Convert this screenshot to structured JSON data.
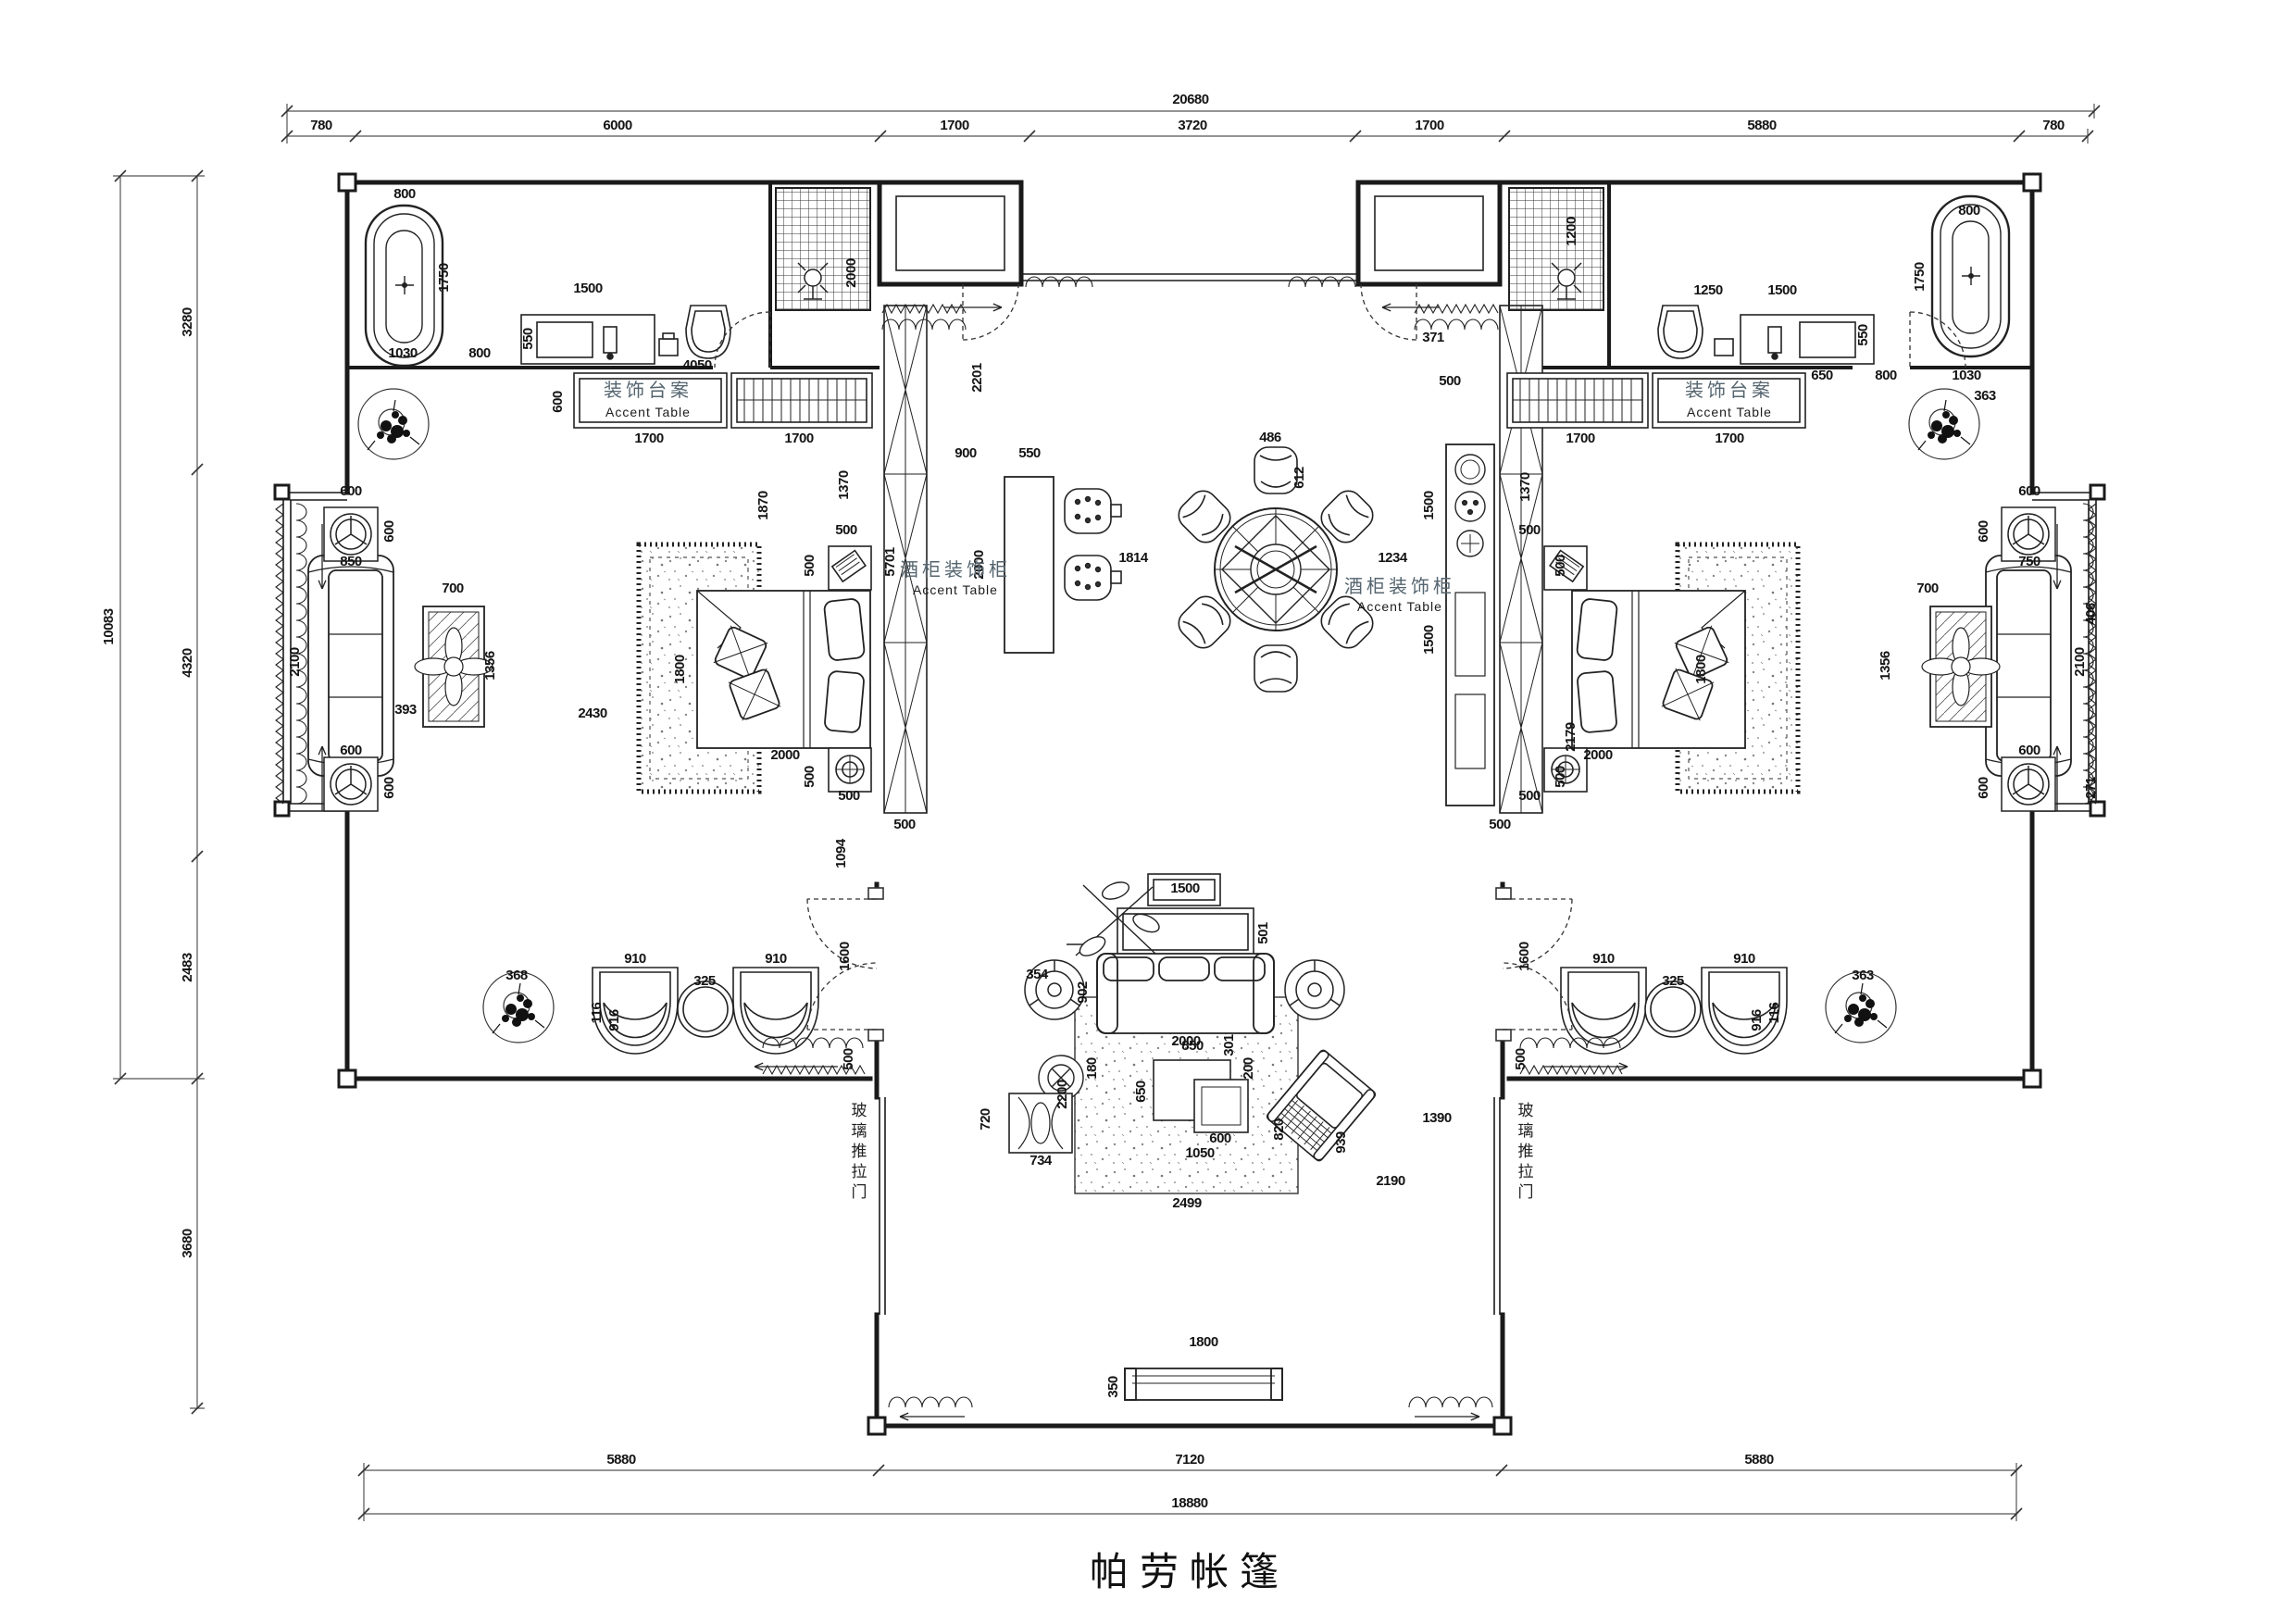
{
  "title": "帕劳帐篷",
  "drawing": {
    "type": "floor-plan",
    "line_color": "#1a1a1a",
    "dim_color": "#141414",
    "room_label_color": "#55656f"
  },
  "room_labels": {
    "accent_table_cn": "装饰台案",
    "accent_table_en": "Accent Table",
    "wine_cabinet_cn": "酒柜装饰柜",
    "wine_cabinet_en": "Accent Table",
    "glass_sliding_door": "玻璃推拉门"
  },
  "annotations": [
    {
      "region": "top-chain",
      "items": [
        [
          "20680",
          1286,
          112
        ],
        [
          "780",
          347,
          140
        ],
        [
          "6000",
          667,
          140
        ],
        [
          "1700",
          1031,
          140
        ],
        [
          "3720",
          1288,
          140
        ],
        [
          "1700",
          1544,
          140
        ],
        [
          "5880",
          1903,
          140
        ],
        [
          "780",
          2218,
          140
        ]
      ]
    },
    {
      "region": "left-chain",
      "items": [
        [
          "10083",
          122,
          677,
          1
        ],
        [
          "3280",
          207,
          348,
          1
        ],
        [
          "4320",
          207,
          716,
          1
        ],
        [
          "2483",
          207,
          1045,
          1
        ],
        [
          "3680",
          207,
          1343,
          1
        ]
      ]
    },
    {
      "region": "bottom-chain",
      "items": [
        [
          "5880",
          671,
          1581
        ],
        [
          "7120",
          1285,
          1581
        ],
        [
          "5880",
          1900,
          1581
        ],
        [
          "18880",
          1285,
          1628
        ]
      ]
    },
    {
      "region": "left-bathroom",
      "items": [
        [
          "800",
          437,
          214
        ],
        [
          "1750",
          484,
          300,
          1
        ],
        [
          "1030",
          435,
          386
        ],
        [
          "800",
          518,
          386
        ],
        [
          "1500",
          635,
          316
        ],
        [
          "550",
          575,
          366,
          1
        ],
        [
          "4050",
          753,
          399
        ],
        [
          "600",
          607,
          434,
          1
        ],
        [
          "1700",
          701,
          478
        ],
        [
          "1700",
          863,
          478
        ],
        [
          "2000",
          924,
          295,
          1
        ],
        [
          "装饰台案",
          700,
          428,
          0,
          "room-cn"
        ],
        [
          "Accent Table",
          700,
          450,
          0,
          "room-en"
        ]
      ]
    },
    {
      "region": "left-cabinet-bar",
      "items": [
        [
          "2201",
          1060,
          408,
          1
        ],
        [
          "900",
          1043,
          494
        ],
        [
          "550",
          1112,
          494
        ],
        [
          "2000",
          1062,
          610,
          1
        ],
        [
          "5701",
          966,
          607,
          1
        ],
        [
          "500",
          977,
          895
        ],
        [
          "酒柜装饰柜",
          1032,
          622,
          0,
          "room-cn"
        ],
        [
          "Accent Table",
          1032,
          642,
          0,
          "room-en"
        ]
      ]
    },
    {
      "region": "left-bedroom",
      "items": [
        [
          "1870",
          829,
          546,
          1
        ],
        [
          "1370",
          916,
          524,
          1
        ],
        [
          "500",
          914,
          577
        ],
        [
          "500",
          879,
          611,
          1
        ],
        [
          "1800",
          739,
          723,
          1
        ],
        [
          "2000",
          848,
          820
        ],
        [
          "500",
          879,
          839,
          1
        ],
        [
          "500",
          917,
          864
        ],
        [
          "1094",
          913,
          922,
          1
        ],
        [
          "2430",
          640,
          775
        ],
        [
          "393",
          438,
          771
        ],
        [
          "700",
          489,
          640
        ],
        [
          "1356",
          534,
          719,
          1
        ],
        [
          "2100",
          323,
          715,
          1
        ],
        [
          "850",
          379,
          611
        ],
        [
          "600",
          379,
          535
        ],
        [
          "600",
          425,
          574,
          1
        ],
        [
          "600",
          379,
          815
        ],
        [
          "600",
          425,
          851,
          1
        ]
      ]
    },
    {
      "region": "left-wing",
      "items": [
        [
          "368",
          558,
          1058
        ],
        [
          "910",
          686,
          1040
        ],
        [
          "325",
          761,
          1064
        ],
        [
          "910",
          838,
          1040
        ],
        [
          "916",
          668,
          1102,
          1
        ],
        [
          "116",
          649,
          1094,
          1
        ],
        [
          "1600",
          917,
          1033,
          1
        ],
        [
          "500",
          921,
          1144,
          1
        ]
      ]
    },
    {
      "region": "dining",
      "items": [
        [
          "486",
          1372,
          477
        ],
        [
          "612",
          1408,
          516,
          1
        ],
        [
          "1814",
          1224,
          607
        ],
        [
          "1234",
          1504,
          607
        ]
      ]
    },
    {
      "region": "kitchen",
      "items": [
        [
          "371",
          1548,
          369
        ],
        [
          "500",
          1566,
          416
        ],
        [
          "1500",
          1548,
          546,
          1
        ],
        [
          "1500",
          1548,
          691,
          1
        ],
        [
          "1370",
          1652,
          526,
          1
        ],
        [
          "2179",
          1701,
          796,
          1
        ],
        [
          "500",
          1620,
          895
        ]
      ]
    },
    {
      "region": "right-cabinet",
      "items": [
        [
          "酒柜装饰柜",
          1512,
          640,
          0,
          "room-cn"
        ],
        [
          "Accent Table",
          1512,
          660,
          0,
          "room-en"
        ]
      ]
    },
    {
      "region": "right-bedroom",
      "items": [
        [
          "500",
          1652,
          577
        ],
        [
          "500",
          1690,
          611,
          1
        ],
        [
          "500",
          1690,
          839,
          1
        ],
        [
          "500",
          1652,
          864
        ],
        [
          "2000",
          1726,
          820
        ],
        [
          "1800",
          1842,
          723,
          1
        ],
        [
          "700",
          2082,
          640
        ],
        [
          "1356",
          2041,
          719,
          1
        ],
        [
          "2100",
          2251,
          715,
          1
        ],
        [
          "406",
          2263,
          663,
          1
        ],
        [
          "750",
          2192,
          611
        ],
        [
          "600",
          2192,
          535
        ],
        [
          "600",
          2147,
          574,
          1
        ],
        [
          "600",
          2192,
          815
        ],
        [
          "600",
          2147,
          851,
          1
        ],
        [
          "271",
          2263,
          851,
          1
        ]
      ]
    },
    {
      "region": "right-wing",
      "items": [
        [
          "910",
          1732,
          1040
        ],
        [
          "325",
          1807,
          1064
        ],
        [
          "910",
          1884,
          1040
        ],
        [
          "363",
          2012,
          1058
        ],
        [
          "116",
          1921,
          1094,
          1
        ],
        [
          "916",
          1902,
          1102,
          1
        ],
        [
          "1600",
          1651,
          1033,
          1
        ],
        [
          "500",
          1647,
          1144,
          1
        ]
      ]
    },
    {
      "region": "right-bathroom",
      "items": [
        [
          "1250",
          1845,
          318
        ],
        [
          "1500",
          1925,
          318
        ],
        [
          "550",
          2017,
          362,
          1
        ],
        [
          "800",
          2127,
          232
        ],
        [
          "1750",
          2078,
          299,
          1
        ],
        [
          "650",
          1968,
          410
        ],
        [
          "800",
          2037,
          410
        ],
        [
          "1030",
          2124,
          410
        ],
        [
          "363",
          2144,
          432
        ],
        [
          "1200",
          1702,
          250,
          1
        ],
        [
          "装饰台案",
          1868,
          428,
          0,
          "room-cn"
        ],
        [
          "Accent Table",
          1868,
          450,
          0,
          "room-en"
        ],
        [
          "1700",
          1707,
          478
        ],
        [
          "1700",
          1868,
          478
        ]
      ]
    },
    {
      "region": "living-room",
      "items": [
        [
          "1500",
          1280,
          964
        ],
        [
          "501",
          1369,
          1008,
          1
        ],
        [
          "902",
          1174,
          1072,
          1
        ],
        [
          "2000",
          1281,
          1129
        ],
        [
          "354",
          1120,
          1057
        ],
        [
          "2200",
          1152,
          1182,
          1
        ],
        [
          "180",
          1184,
          1154,
          1
        ],
        [
          "850",
          1288,
          1134
        ],
        [
          "301",
          1332,
          1129,
          1
        ],
        [
          "650",
          1237,
          1179,
          1
        ],
        [
          "200",
          1353,
          1154,
          1
        ],
        [
          "600",
          1318,
          1234
        ],
        [
          "1050",
          1296,
          1250
        ],
        [
          "820",
          1386,
          1220,
          1
        ],
        [
          "939",
          1453,
          1234,
          1
        ],
        [
          "2499",
          1282,
          1304
        ],
        [
          "2190",
          1502,
          1280
        ],
        [
          "1390",
          1552,
          1212
        ],
        [
          "734",
          1124,
          1258
        ],
        [
          "720",
          1069,
          1209,
          1
        ]
      ]
    },
    {
      "region": "terrace",
      "items": [
        [
          "1800",
          1300,
          1454
        ],
        [
          "350",
          1207,
          1498,
          1
        ],
        [
          "玻璃推拉门",
          928,
          1205,
          "v",
          "vlabel"
        ],
        [
          "玻璃推拉门",
          1648,
          1205,
          "v",
          "vlabel"
        ]
      ]
    }
  ]
}
